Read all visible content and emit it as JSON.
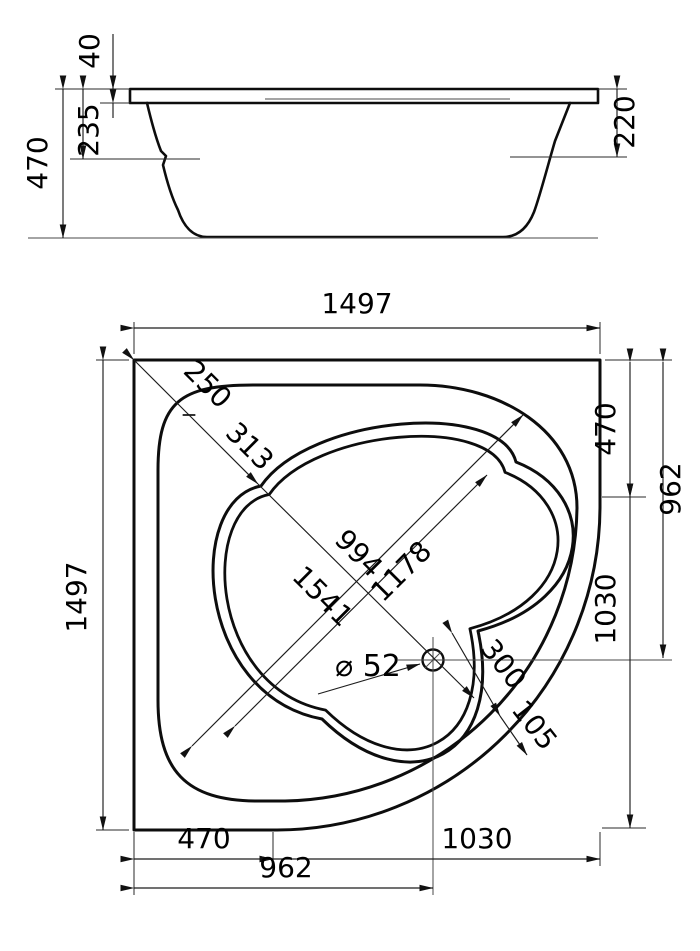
{
  "drawing_title": "corner bathtub dimensional drawing",
  "side_view": {
    "total_height": "470",
    "rim_thickness": "40",
    "rim_to_step": "235",
    "rim_to_edge": "220"
  },
  "plan_view": {
    "overall_width": "1497",
    "overall_length": "1497",
    "diagonal": {
      "corner_to_rim": "250",
      "rim_to_basin": "313",
      "basin_diagonal": "994",
      "rim_diagonal": "1541",
      "basin_long_diagonal": "1178"
    },
    "drain": {
      "diameter": "⌀ 52",
      "basin_to_rim": "300",
      "rim_width": "105"
    },
    "right_side": {
      "straight_edge": "470",
      "to_drain_axis": "962",
      "corner_radius": "1030"
    },
    "bottom_side": {
      "straight_edge": "470",
      "corner_radius": "1030",
      "to_drain_axis": "962"
    }
  }
}
